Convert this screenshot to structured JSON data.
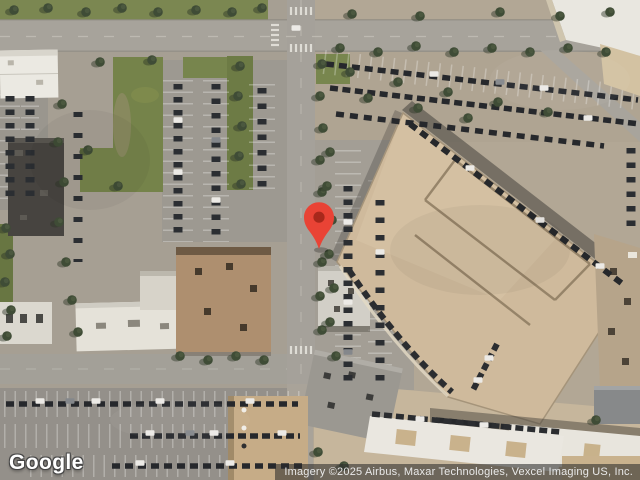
{
  "branding": {
    "google_logo_text": "Google"
  },
  "attribution": {
    "text": "Imagery ©2025 Airbus, Maxar Technologies, Vexcel Imaging US, Inc."
  },
  "map": {
    "view_type": "satellite",
    "pin": {
      "color": "#E94335",
      "dot_color": "#A8281B"
    }
  }
}
